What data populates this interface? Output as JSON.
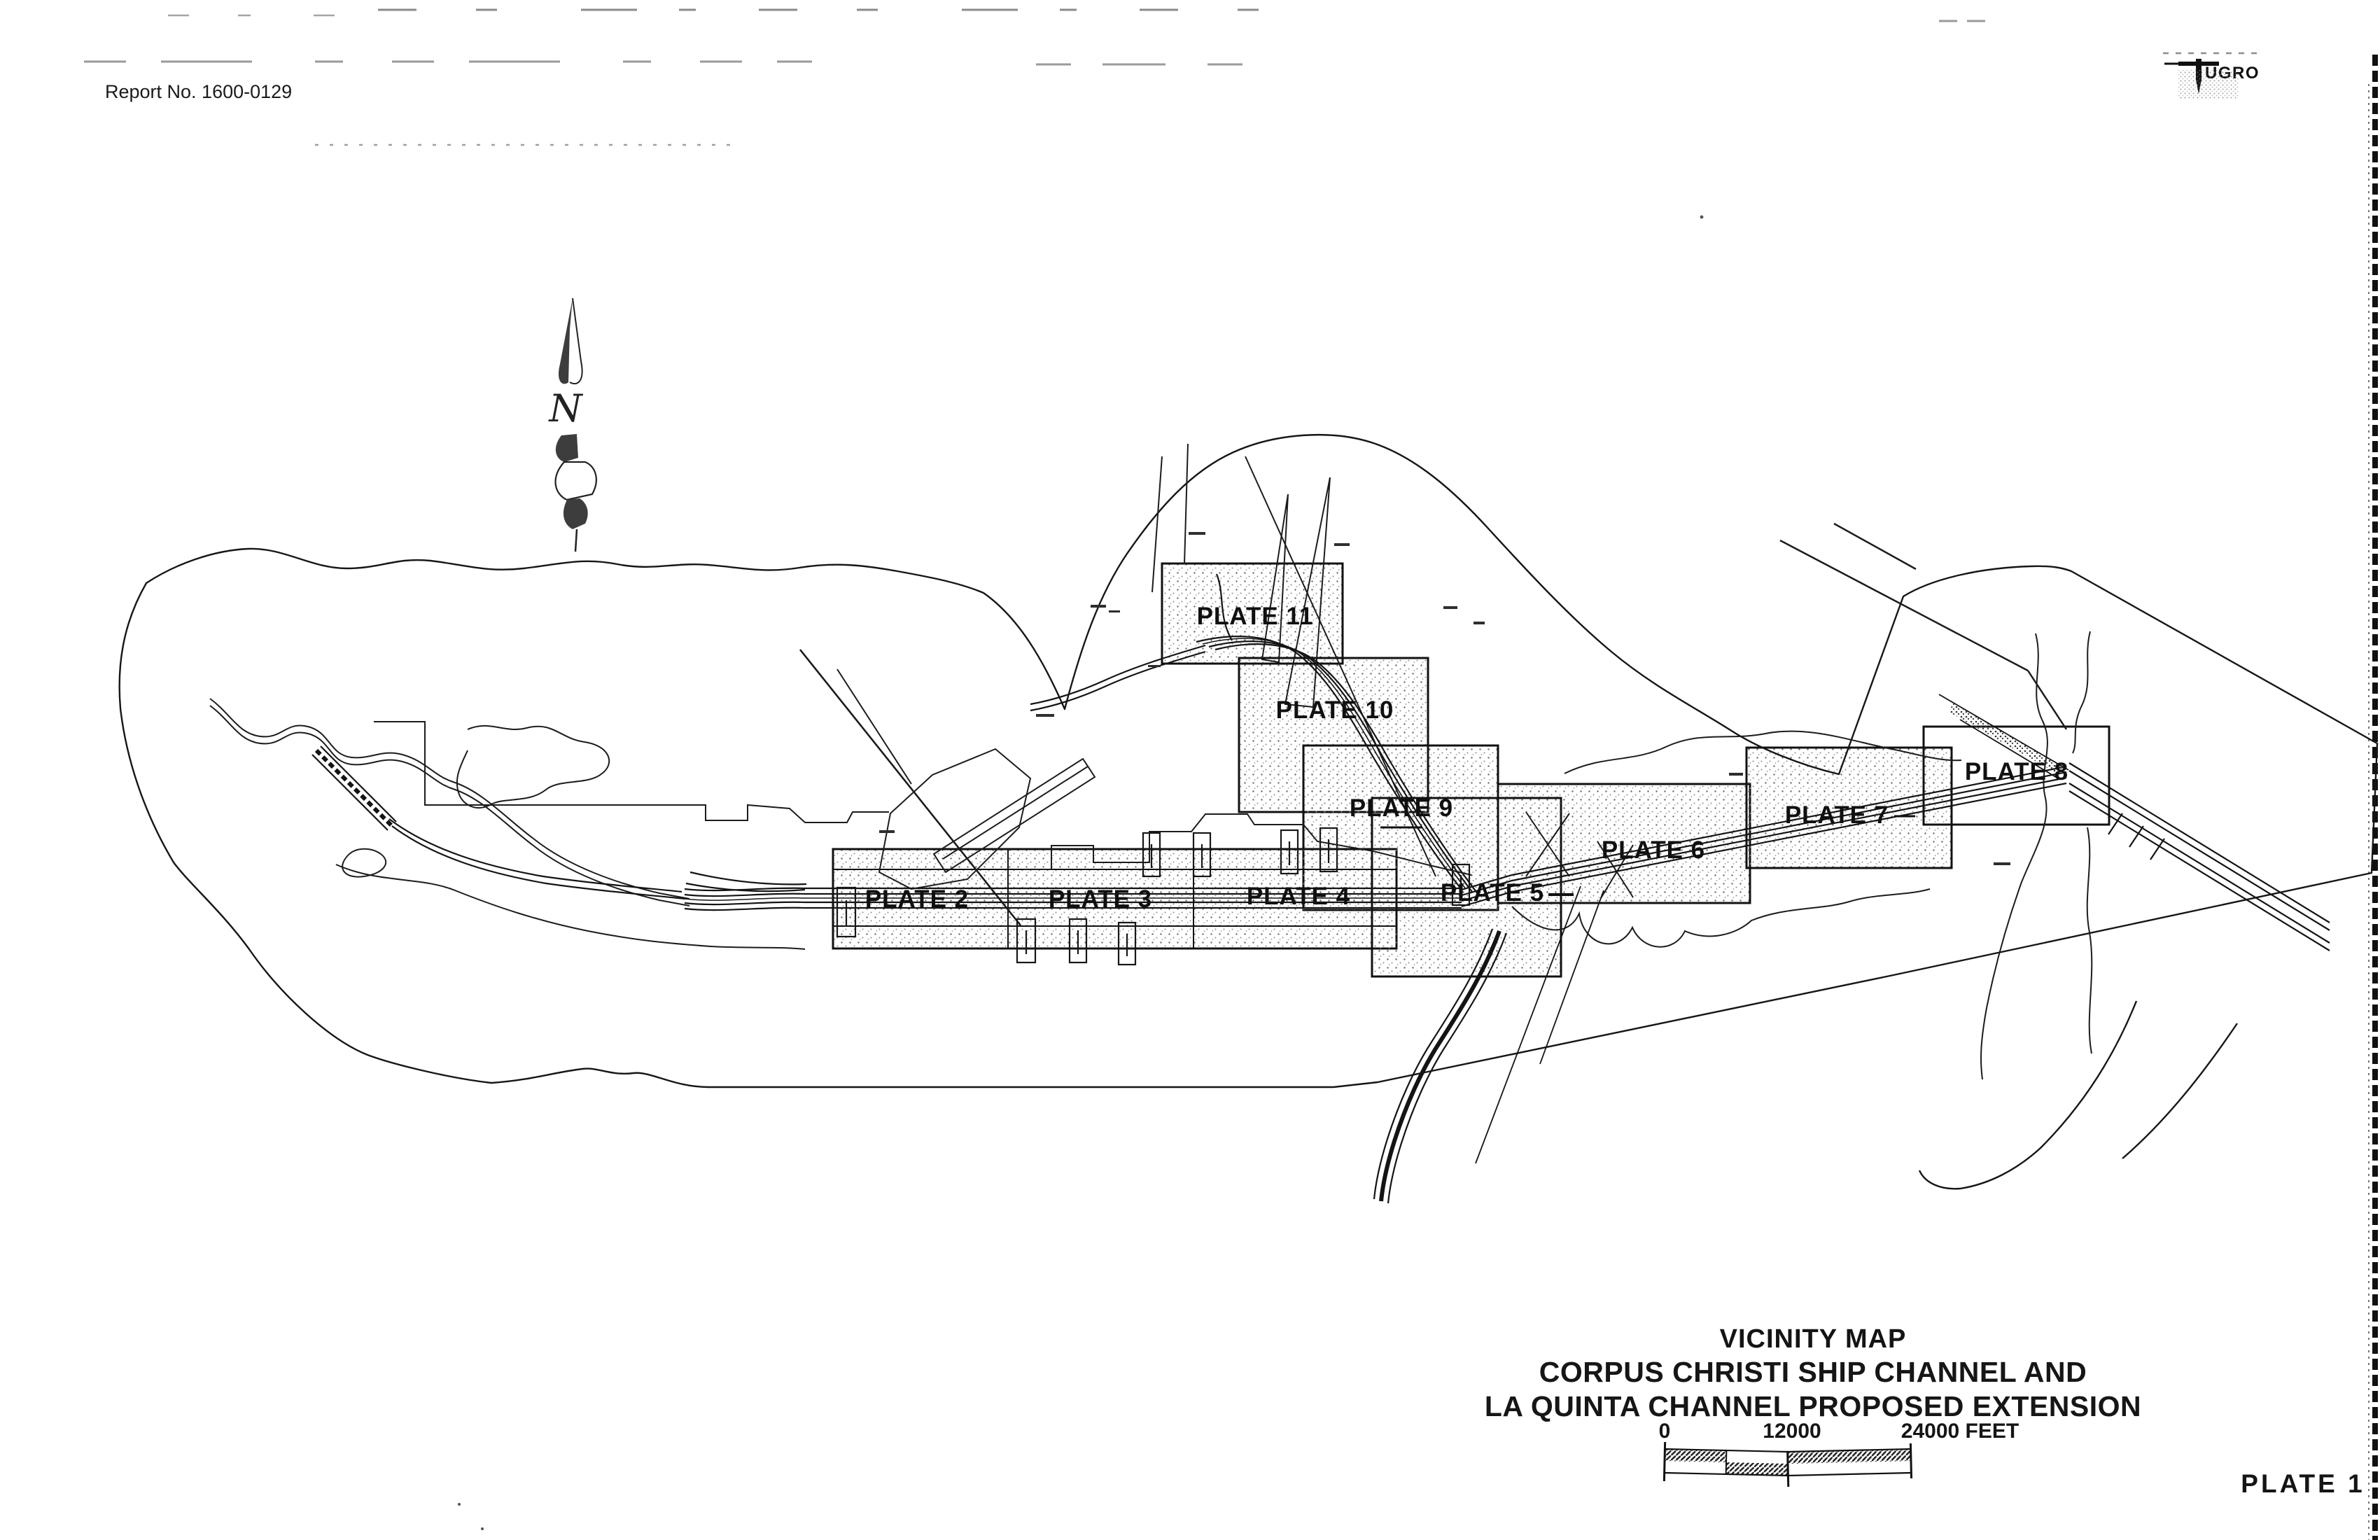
{
  "page": {
    "report_no": "Report No. 1600-0129"
  },
  "branding": {
    "name": "FUGRO",
    "wordmark": "UGRO"
  },
  "compass": {
    "label": "N"
  },
  "map": {
    "plates": [
      "PLATE 2",
      "PLATE 3",
      "PLATE 4",
      "PLATE 5",
      "PLATE 6",
      "PLATE 7",
      "PLATE 8",
      "PLATE 9",
      "PLATE 10",
      "PLATE 11"
    ]
  },
  "title_block": {
    "title": "VICINITY MAP",
    "subtitle_line1": "CORPUS CHRISTI SHIP CHANNEL AND",
    "subtitle_line2": "LA QUINTA CHANNEL PROPOSED EXTENSION"
  },
  "scale_bar": {
    "tick_start": "0",
    "tick_middle": "12000",
    "tick_end": "24000 FEET"
  },
  "footer": {
    "plate_no": "PLATE 1"
  },
  "colors": {
    "ink": "#1a1a1a",
    "paper": "#ffffff"
  }
}
